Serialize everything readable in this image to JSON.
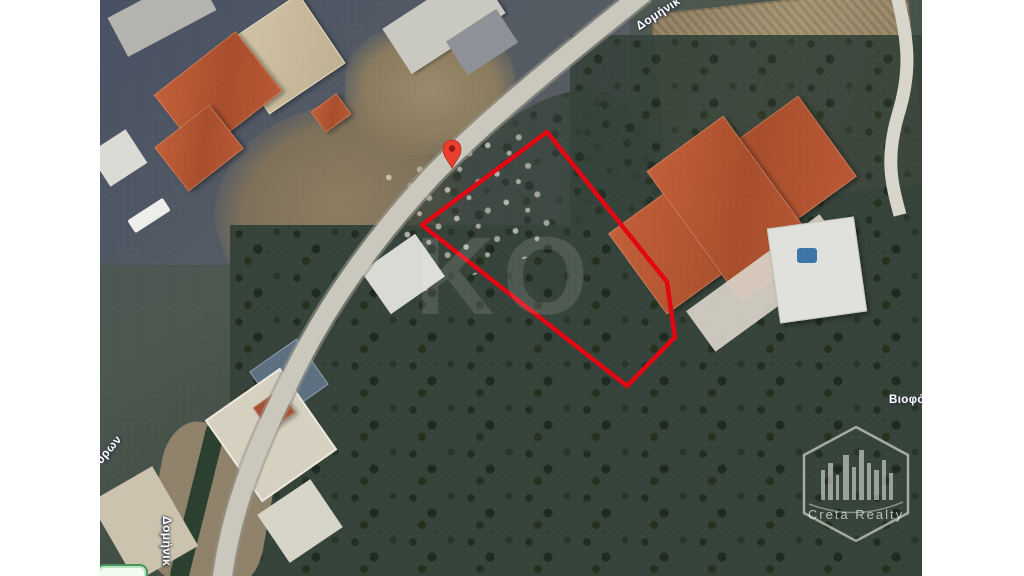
{
  "map": {
    "type": "satellite",
    "street_labels": [
      {
        "id": "top",
        "text": "Δομήνικ"
      },
      {
        "id": "bottom-left",
        "text": "Δομήνικ"
      },
      {
        "id": "left",
        "text": "ύρων"
      },
      {
        "id": "right",
        "text": "Βιοφό"
      }
    ]
  },
  "overlay": {
    "polygon_points": "547,132 667,282 675,337 627,386 422,225",
    "polygon_color": "#e30613",
    "pin_color": "#e8402d",
    "pin_dot_color": "#8e1a12"
  },
  "watermarks": {
    "center_text": "KO",
    "brand_name": "Creta Realty"
  }
}
